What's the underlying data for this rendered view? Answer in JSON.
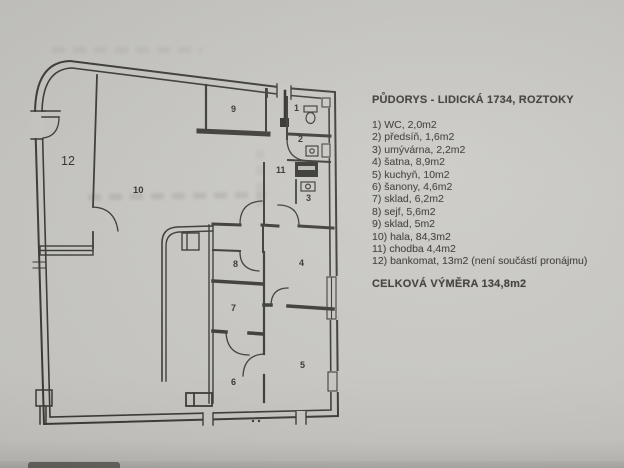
{
  "legend": {
    "title": "PŮDORYS - LIDICKÁ 1734, ROZTOKY",
    "items": [
      "1) WC, 2,0m2",
      "2) předsíň, 1,6m2",
      "3) umývárna, 2,2m2",
      "4) šatna, 8,9m2",
      "5) kuchyň, 10m2",
      "6) šanony, 4,6m2",
      "7) sklad, 6,2m2",
      "8) sejf, 5,6m2",
      "9) sklad, 5m2",
      "10) hala, 84,3m2",
      "11) chodba 4,4m2",
      "12) bankomat, 13m2 (není součástí pronájmu)",
      "CELKOVÁ VÝMĚRA 134,8m2"
    ]
  },
  "plan": {
    "labels": [
      {
        "room": "wc",
        "text": "1"
      },
      {
        "room": "predsin",
        "text": "2"
      },
      {
        "room": "umyvarna",
        "text": "3"
      },
      {
        "room": "satna",
        "text": "4"
      },
      {
        "room": "kuchyn",
        "text": "5"
      },
      {
        "room": "sanony",
        "text": "6"
      },
      {
        "room": "sklad7",
        "text": "7"
      },
      {
        "room": "sejf",
        "text": "8"
      },
      {
        "room": "sklad9",
        "text": "9"
      },
      {
        "room": "hala",
        "text": "10"
      },
      {
        "room": "chodba",
        "text": "11"
      },
      {
        "room": "bankomat",
        "text": "12"
      }
    ]
  },
  "colors": {
    "paper": "#c9c8c4",
    "ink": "#3b3a35",
    "ink_dark": "#2f2e2a"
  }
}
